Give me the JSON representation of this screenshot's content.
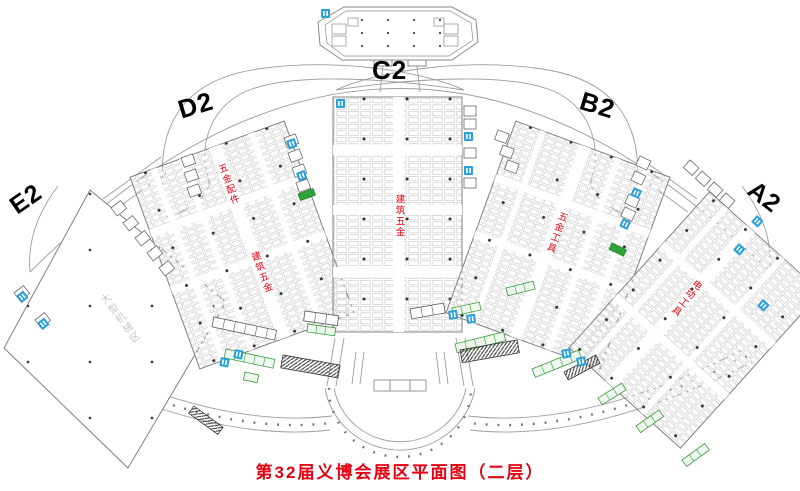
{
  "caption": "第32届义博会展区平面图（二层）",
  "zones": [
    {
      "id": "E2",
      "label": "E2",
      "area_text": "大型机械区"
    },
    {
      "id": "D2",
      "label": "D2",
      "text_upper": "五金配件",
      "text_lower": "建筑五金"
    },
    {
      "id": "C2",
      "label": "C2",
      "text": "建筑五金"
    },
    {
      "id": "B2",
      "label": "B2",
      "text": "五金工具"
    },
    {
      "id": "A2",
      "label": "A2",
      "text": "电动工具"
    }
  ],
  "colors": {
    "label_black": "#000000",
    "hall_text_red": "#e60012",
    "caption_red": "#e60012",
    "wc_blue": "#2b9fd8",
    "escalator_green": "#2fa23c",
    "booth_line_gray": "#c4c4c4",
    "wall_gray": "#808080"
  },
  "icons": {
    "wc": "restroom-icon",
    "escalator": "escalator-icon"
  }
}
